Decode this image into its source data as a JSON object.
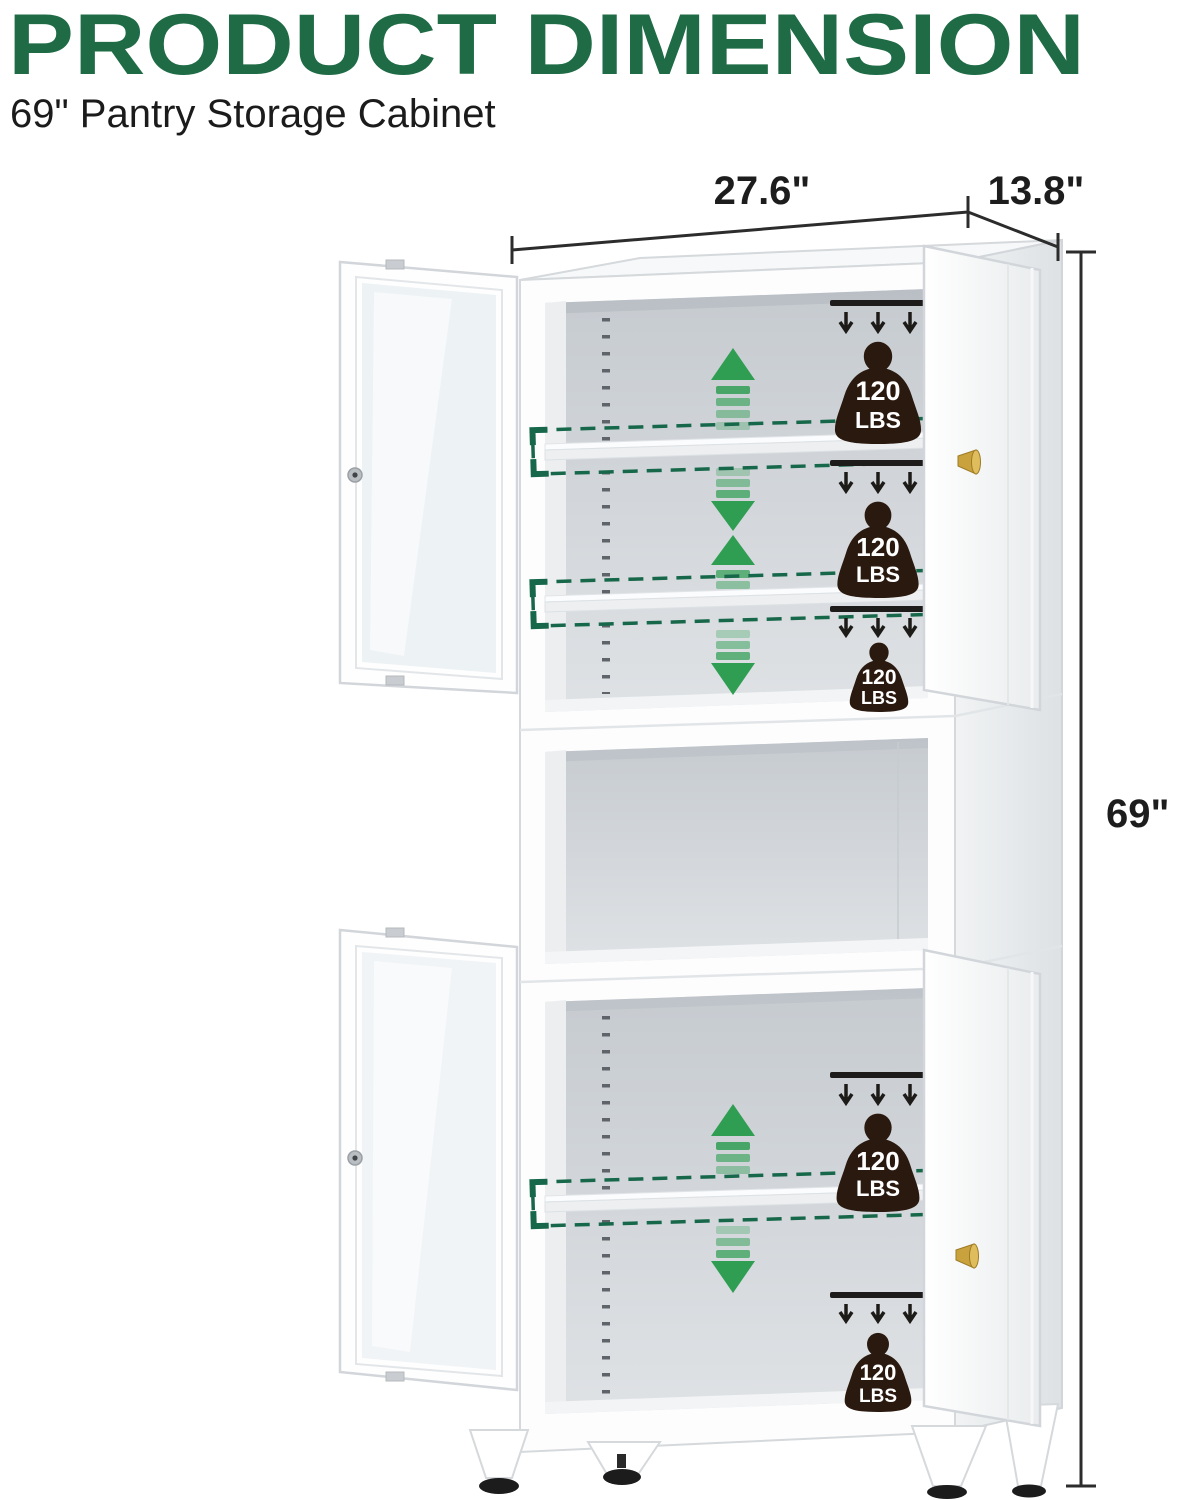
{
  "page": {
    "background": "#ffffff"
  },
  "header": {
    "title": "PRODUCT DIMENSION",
    "subtitle": "69\" Pantry Storage Cabinet"
  },
  "dimension_labels": {
    "width": "27.6\"",
    "depth": "13.8\"",
    "height": "69\""
  },
  "weight_badges": [
    {
      "value": "120",
      "unit": "LBS"
    },
    {
      "value": "120",
      "unit": "LBS"
    },
    {
      "value": "120",
      "unit": "LBS"
    },
    {
      "value": "120",
      "unit": "LBS"
    },
    {
      "value": "120",
      "unit": "LBS"
    }
  ],
  "icons": {
    "weight_badge": "kettlebell-weight-icon",
    "load_arrows": "triple-down-arrow-icon",
    "shelf_adjust": "up-down-fading-arrow-icon",
    "knob": "gold-knob-icon",
    "keyhole": "lock-keyhole-icon"
  },
  "colors": {
    "title_green": "#1e6b45",
    "arrow_green": "#2f9e53",
    "shelf_highlight_green": "#17684a",
    "weight_badge_brown": "#2a190f",
    "knob_gold": "#c9a23e",
    "dimension_line": "#2c2c2c"
  }
}
